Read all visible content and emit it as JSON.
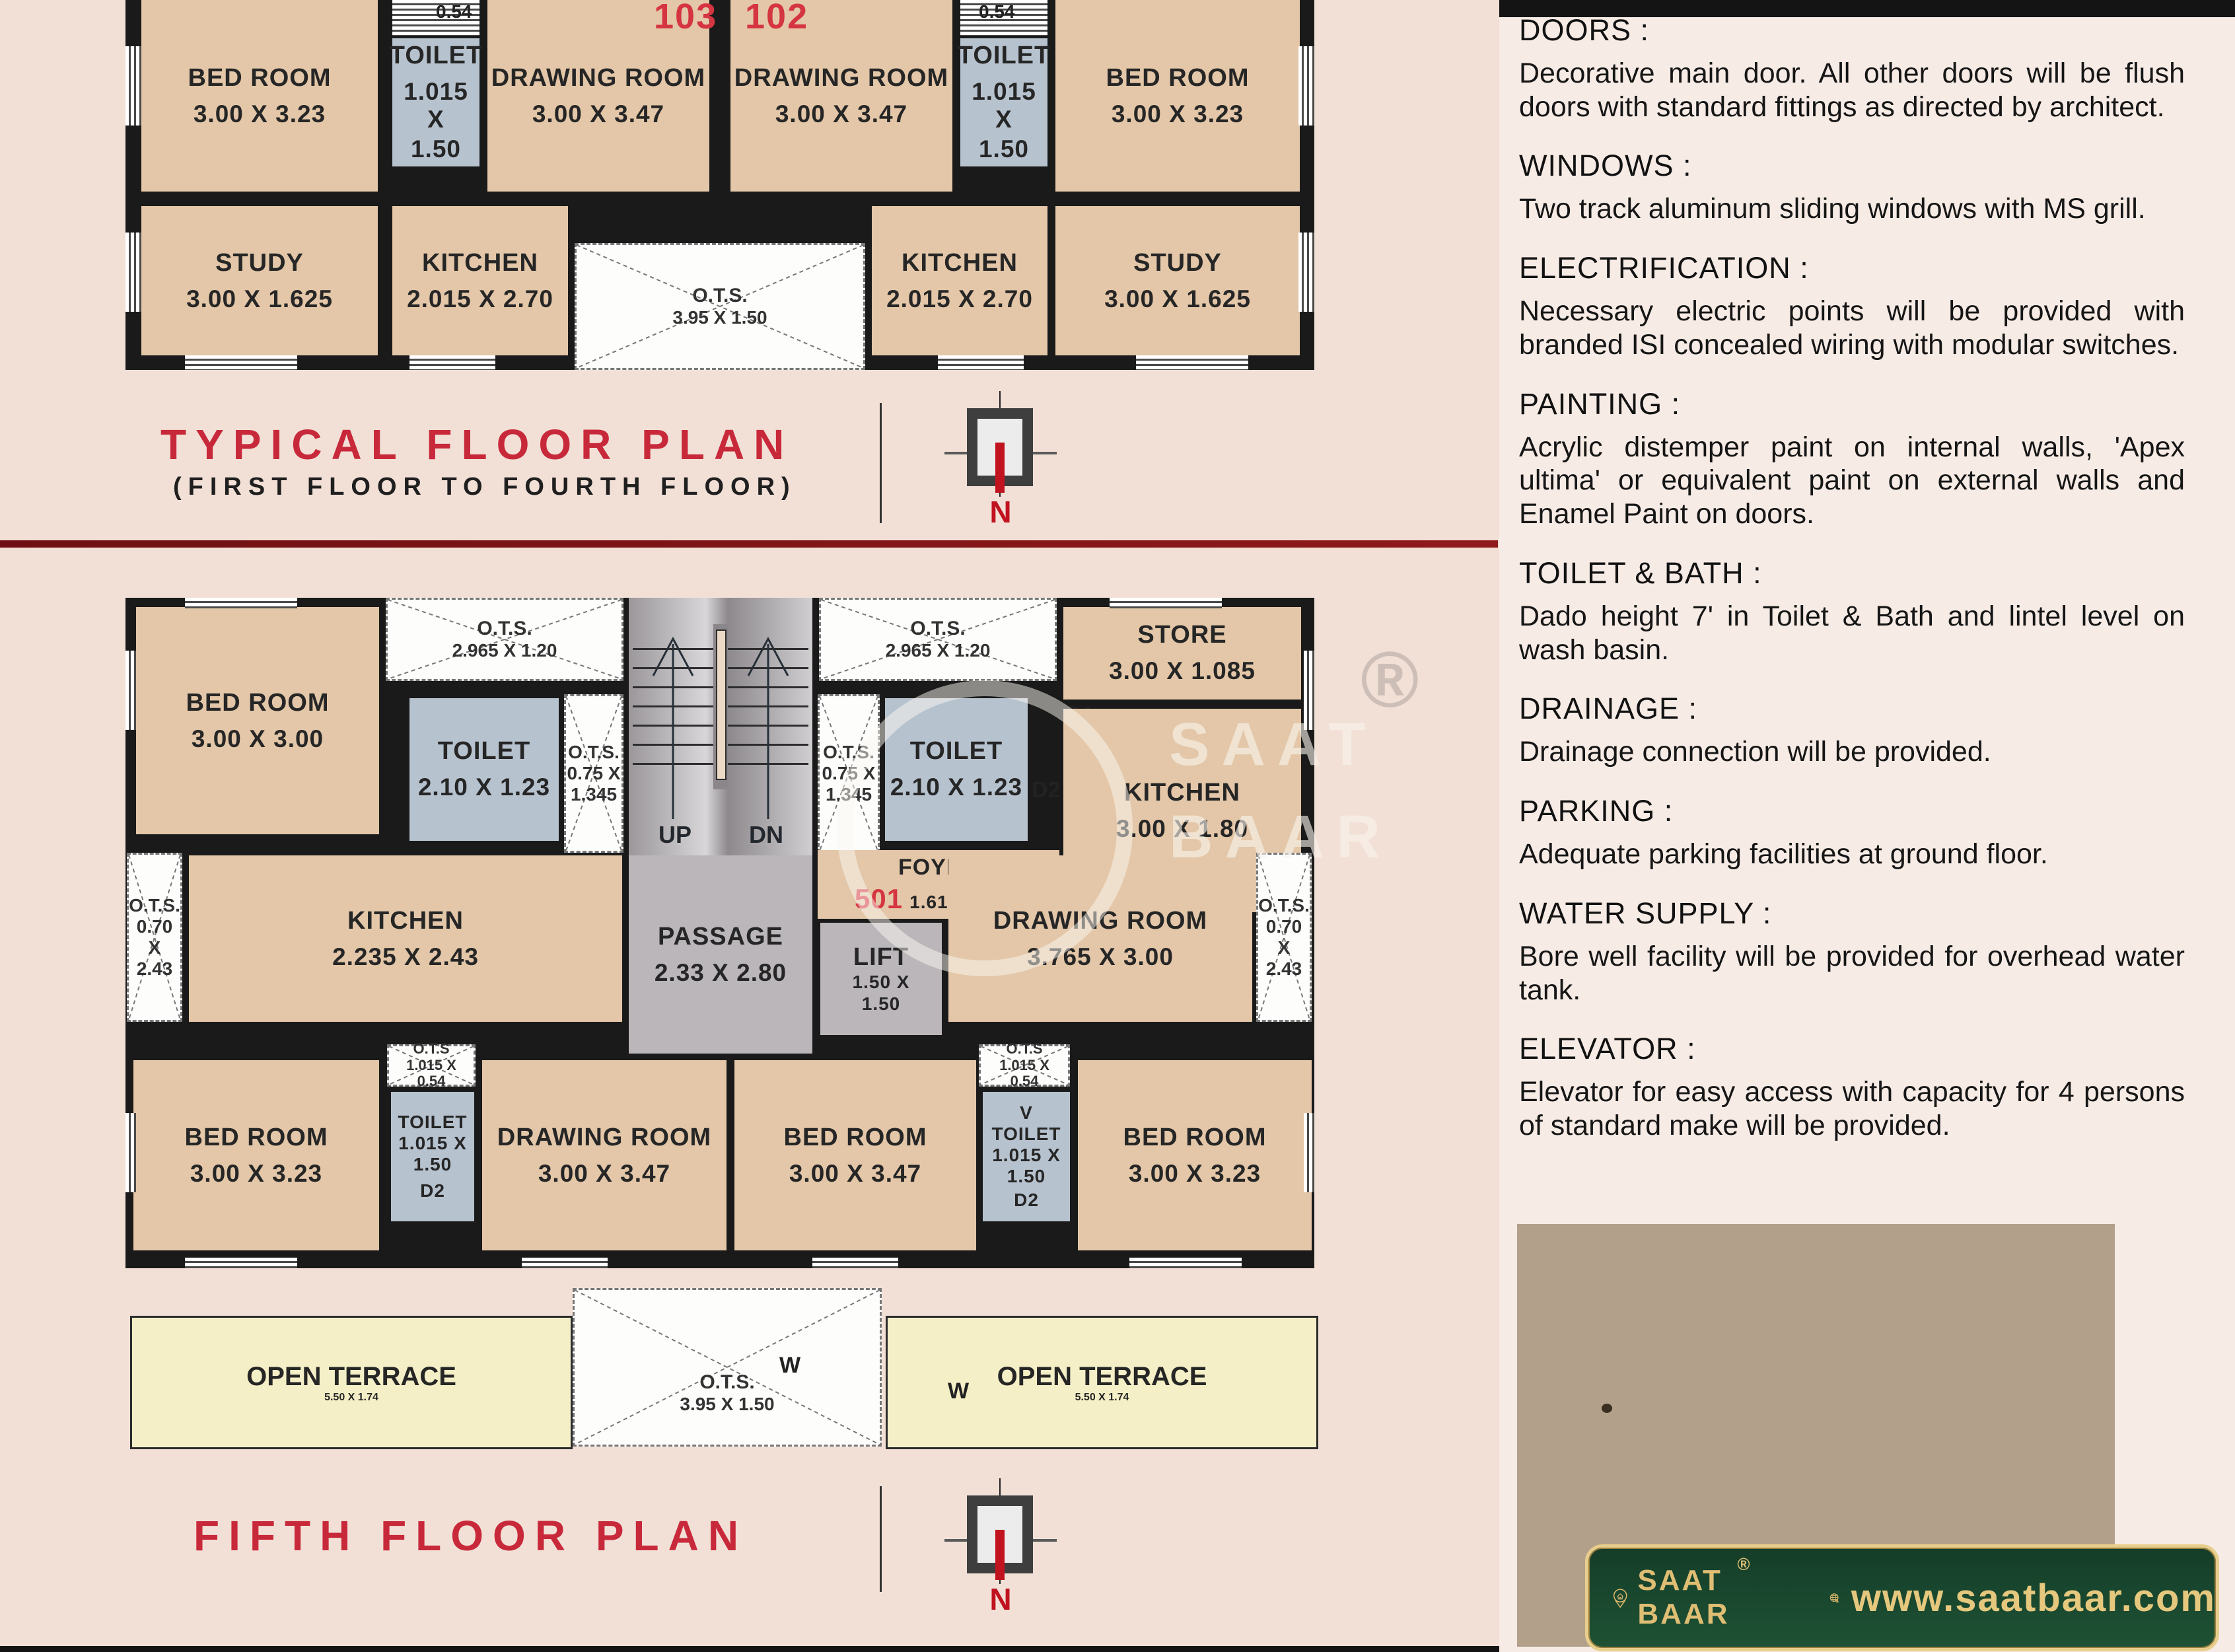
{
  "typical_plan": {
    "unit_left": "103",
    "unit_right": "102",
    "title": "TYPICAL FLOOR PLAN",
    "subtitle": "(FIRST FLOOR TO FOURTH FLOOR)",
    "compass_n": "N",
    "rooms": {
      "bedroom": {
        "label": "BED ROOM",
        "dims": "3.00 X 3.23"
      },
      "toilet": {
        "label": "TOILET",
        "dims_l1": "1.015 X",
        "dims_l2": "1.50",
        "ots_top": "0.54"
      },
      "drawing": {
        "label": "DRAWING ROOM",
        "dims": "3.00 X 3.47"
      },
      "study": {
        "label": "STUDY",
        "dims": "3.00 X 1.625"
      },
      "kitchen": {
        "label": "KITCHEN",
        "dims": "2.015 X 2.70"
      },
      "ots": {
        "label": "O.T.S.",
        "dims": "3.95 X 1.50"
      }
    }
  },
  "fifth_plan": {
    "title": "FIFTH FLOOR PLAN",
    "compass_n": "N",
    "unit_501": "501",
    "unit_502": "502",
    "rooms": {
      "bedroom_top": {
        "label": "BED ROOM",
        "dims": "3.00 X 3.00"
      },
      "ots_top": {
        "label": "O.T.S.",
        "dims": "2.965 X 1.20"
      },
      "store": {
        "label": "STORE",
        "dims": "3.00 X 1.085",
        "door": "D1"
      },
      "toilet_mid": {
        "label": "TOILET",
        "dims": "2.10 X 1.23",
        "door": "D2"
      },
      "ots_mid": {
        "l1": "O.T.S.",
        "l2": "0.75 X",
        "l3": "1.345"
      },
      "kitchen_right": {
        "label": "KITCHEN",
        "dims": "3.00 X 1.80"
      },
      "stairs": {
        "up": "UP",
        "dn": "DN"
      },
      "foyer": {
        "label": "FOYER",
        "dims": "1.615 X 1.27"
      },
      "passage": {
        "label": "PASSAGE",
        "dims": "2.33 X 2.80"
      },
      "lift": {
        "label": "LIFT",
        "dims_l1": "1.50 X",
        "dims_l2": "1.50"
      },
      "ots_side": {
        "l1": "O.T.S.",
        "l2": "0.70 X",
        "l3": "2.43"
      },
      "kitchen_left": {
        "label": "KITCHEN",
        "dims": "2.235 X 2.43"
      },
      "drawing_mid": {
        "label": "DRAWING ROOM",
        "dims": "3.765 X 3.00"
      },
      "ots_small": {
        "l1": "O.T.S",
        "l2": "1.015 X",
        "l3": "0.54"
      },
      "toilet_small": {
        "label": "TOILET",
        "dims_l1": "1.015 X",
        "dims_l2": "1.50",
        "door": "D2",
        "vent": "V"
      },
      "bedroom_323": {
        "label": "BED ROOM",
        "dims": "3.00 X 3.23"
      },
      "bedroom_347": {
        "label": "BED ROOM",
        "dims": "3.00 X 3.47"
      },
      "drawing_bottom": {
        "label": "DRAWING ROOM",
        "dims": "3.00 X 3.47"
      },
      "terrace": {
        "label": "OPEN TERRACE",
        "dims": "5.50 X 1.74"
      },
      "ots_bottom": {
        "label": "O.T.S.",
        "dims": "3.95 X 1.50",
        "window": "W"
      }
    }
  },
  "specs": {
    "sections": [
      {
        "heading": "DOORS :",
        "body": "Decorative main door. All other doors will be flush doors with standard fittings as directed by architect."
      },
      {
        "heading": "WINDOWS :",
        "body": "Two track aluminum sliding windows with MS grill."
      },
      {
        "heading": "ELECTRIFICATION :",
        "body": "Necessary electric points will be provided with branded ISI concealed wiring with modular switches."
      },
      {
        "heading": "PAINTING :",
        "body": "Acrylic distemper paint on internal walls, 'Apex ultima' or equivalent paint on external walls and Enamel Paint on doors."
      },
      {
        "heading": "TOILET & BATH :",
        "body": "Dado height 7' in Toilet & Bath and lintel level on wash basin."
      },
      {
        "heading": "DRAINAGE :",
        "body": "Drainage connection will be provided."
      },
      {
        "heading": "PARKING :",
        "body": "Adequate parking facilities at ground floor."
      },
      {
        "heading": "WATER SUPPLY :",
        "body": "Bore well facility will be provided for overhead water tank."
      },
      {
        "heading": "ELEVATOR :",
        "body": "Elevator for easy access with capacity for 4 persons of standard make will be provided."
      }
    ]
  },
  "watermark": {
    "reg": "®",
    "line1": "SAAT",
    "line2": "BAAR"
  },
  "footer": {
    "brand_l1": "SAAT",
    "brand_l2": "BAAR",
    "reg": "®",
    "url": "www.saatbaar.com"
  },
  "colors": {
    "accent_red": "#c8293a",
    "wall": "#1a1a1a",
    "room_tan": "#e3c7a8",
    "toilet_blue": "#b7c2cf",
    "terrace_yellow": "#f5efc7",
    "banner_green": "#1e5234",
    "gold": "#dfbe74",
    "maroon_rule": "#7c1215"
  }
}
